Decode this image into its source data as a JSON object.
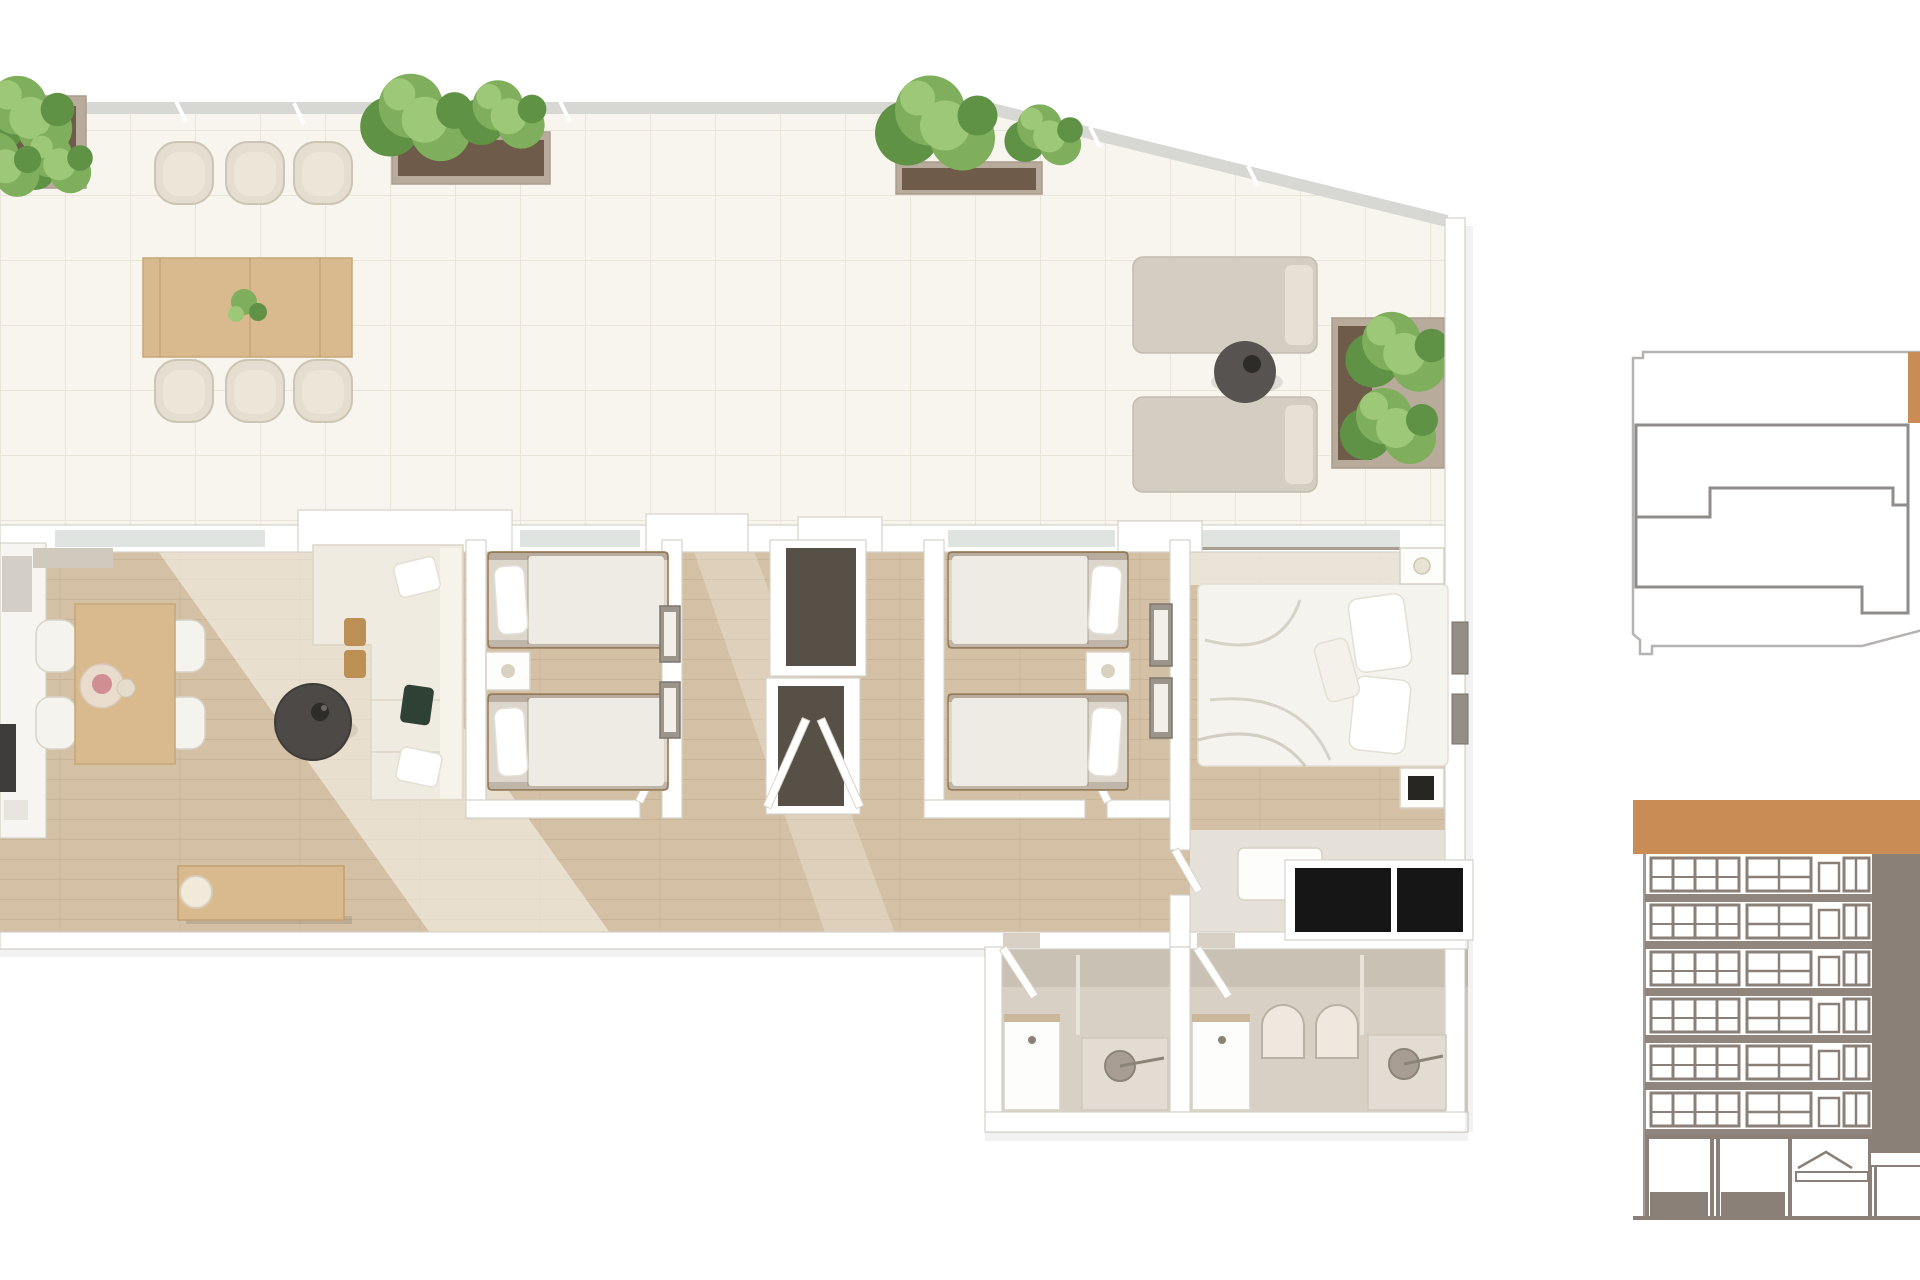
{
  "meta": {
    "title": "3D apartment floor plan render with roof terrace, key plan and building elevation",
    "canvas_width": 1920,
    "canvas_height": 1280,
    "visible_text": []
  },
  "colors": {
    "terrace-tile": "#f8f5ee",
    "tile-line": "#e9e5d9",
    "railing": "#d7d8d4",
    "wall-line": "#d6d1c8",
    "glass": "#dfe4e1",
    "wood-floor": "#d3c0a5",
    "wood-table": "#d8ba8e",
    "chair-beige": "#e4ddd0",
    "lounger": "#d4cdc1",
    "lounger-pillow": "#e7e1d5",
    "side-table-dark": "#575350",
    "sofa-cream": "#efebe1",
    "cushion-green": "#2f4134",
    "cushion-tan": "#bc9055",
    "dark-panel": "#565047",
    "black-wardrobe": "#161616",
    "bed-linen": "#f5f3ee",
    "mattress": "#dcd6cc",
    "duvet": "#edebe4",
    "bath-floor": "#d8d0c4",
    "fixture-grey": "#a79d92",
    "plant-mid": "#7fae5c",
    "plant-light": "#9cc877",
    "plant-dark": "#5f9245",
    "soil": "#6f5b49",
    "planter-box": "#b9ab9c",
    "accent-orange": "#c98c55",
    "elev-frame": "#8b8077",
    "plan-light": "#b5b3af",
    "plan-dark": "#8f8d89"
  },
  "scene": {
    "type": "3d-floor-plan-top-view-render",
    "terrace": {
      "planters": 4,
      "outdoor_dining_chairs": 6,
      "outdoor_dining_tables": 1,
      "sun_loungers": 2,
      "round_side_tables": 1,
      "railing_type": "glass-balustrade"
    },
    "interior": {
      "living_dining": {
        "dining_chairs": 4,
        "dining_tables": 1,
        "sofas": 1,
        "round_coffee_tables": 1,
        "sideboards": 1,
        "table_lamps": 1,
        "kitchen_appliances": 1
      },
      "bedroom_twin_1": {
        "beds": 2,
        "nightstands": 1,
        "wall_art": 2
      },
      "bedroom_twin_2": {
        "beds": 2,
        "nightstands": 1,
        "wall_art": 2
      },
      "master_bedroom": {
        "beds": 1,
        "nightstands": 2,
        "benches": 1,
        "black_wardrobe_panels": 2,
        "wall_art": 2
      },
      "entry_vestibule": {
        "dark_wardrobe_panels": 2,
        "open_door_leaves": 2
      },
      "bathrooms": {
        "count": 2,
        "vanities": 2,
        "showers": 2
      }
    },
    "key_plan": {
      "highlighted_unit": true,
      "units_outlined": 2,
      "cut_off_right_edge": true
    },
    "elevation": {
      "floors": 6,
      "roof_band": true,
      "dark_core_column": true,
      "ground_floor_openings": 2,
      "cut_off_right_edge": true
    }
  }
}
